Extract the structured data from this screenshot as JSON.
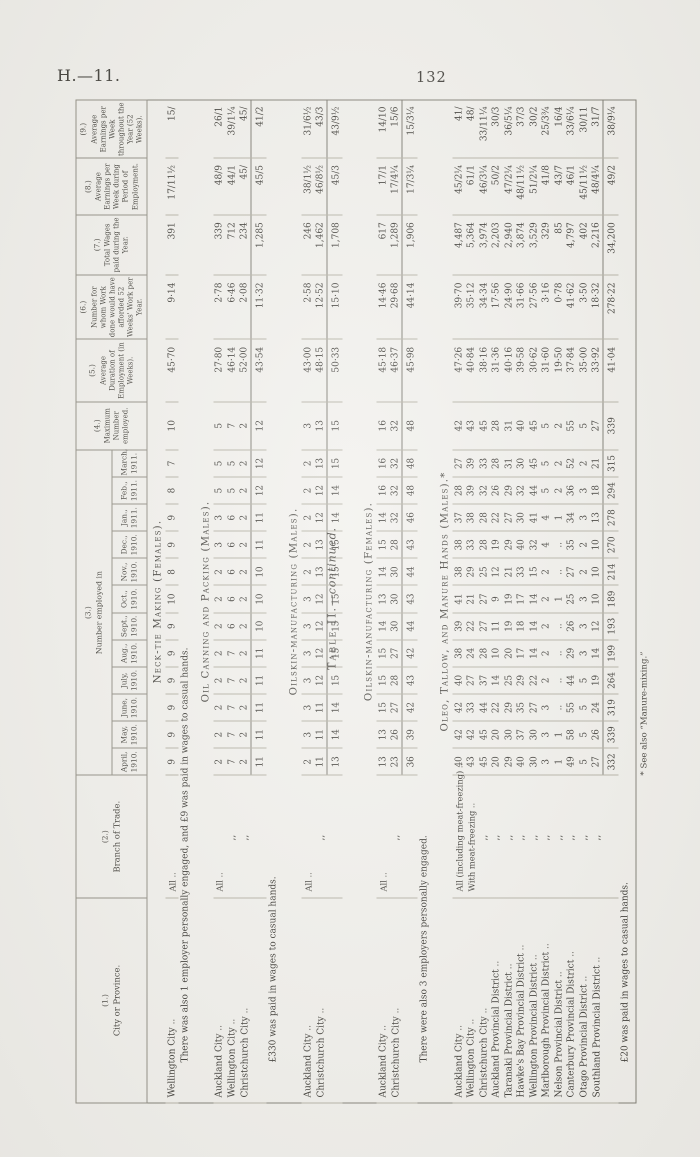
{
  "page": {
    "doc_ref": "H.—11.",
    "page_number": "132",
    "table_title_main": "Table II.",
    "table_title_cont": "—continued.",
    "footnote": "* See also “Manure-mixing.”"
  },
  "table": {
    "headers": {
      "c1": {
        "num": "(1.)",
        "label": "City or Province."
      },
      "c2": {
        "num": "(2.)",
        "label": "Branch of Trade."
      },
      "c3": {
        "num": "(3.)",
        "label": "Number employed in"
      },
      "months": [
        {
          "name": "April,",
          "year": "1910."
        },
        {
          "name": "May,",
          "year": "1910."
        },
        {
          "name": "June,",
          "year": "1910."
        },
        {
          "name": "July,",
          "year": "1910."
        },
        {
          "name": "Aug.,",
          "year": "1910."
        },
        {
          "name": "Sept.,",
          "year": "1910."
        },
        {
          "name": "Oct.,",
          "year": "1910."
        },
        {
          "name": "Nov.,",
          "year": "1910."
        },
        {
          "name": "Dec.,",
          "year": "1910."
        },
        {
          "name": "Jan.,",
          "year": "1911."
        },
        {
          "name": "Feb.,",
          "year": "1911."
        },
        {
          "name": "March,",
          "year": "1911."
        }
      ],
      "c4": {
        "num": "(4.)",
        "label": "Maximum Number employed."
      },
      "c5": {
        "num": "(5.)",
        "label": "Average Duration of Employment (in Weeks)."
      },
      "c6": {
        "num": "(6.)",
        "label": "Number for whom Work done would have afforded 52 Weeks' Work per Year."
      },
      "c7": {
        "num": "(7.)",
        "label": "Total Wages paid during the Year."
      },
      "c8": {
        "num": "(8.)",
        "label": "Average Earnings per Week during Period of Employment."
      },
      "c9": {
        "num": "(9.)",
        "label": "Average Earnings per Week throughout the Year (52 Weeks)."
      }
    },
    "sections": [
      {
        "title": "Neck-tie Making (Females).",
        "rows": [
          {
            "city": "Wellington City",
            "branch": "All",
            "months": [
              9,
              9,
              9,
              9,
              9,
              9,
              10,
              8,
              9,
              9,
              8,
              7
            ],
            "max": 10,
            "avg_duration": "45·70",
            "weeks_work_number": "9·14",
            "total_wages": "391",
            "earnings_period": "17/11½",
            "earnings_year": "15/"
          }
        ],
        "note": "There was also 1 employer personally engaged, and £9 was paid in wages to casual hands."
      },
      {
        "title": "Oil Canning and Packing (Males).",
        "rows": [
          {
            "city": "Auckland City",
            "branch": "All",
            "months": [
              2,
              2,
              2,
              2,
              2,
              2,
              2,
              2,
              3,
              3,
              5,
              5
            ],
            "max": 5,
            "avg_duration": "27·80",
            "weeks_work_number": "2·78",
            "total_wages": "339",
            "earnings_period": "48/9",
            "earnings_year": "26/1"
          },
          {
            "city": "Wellington City",
            "branch": ",,",
            "months": [
              7,
              7,
              7,
              7,
              7,
              6,
              6,
              6,
              6,
              6,
              5,
              5
            ],
            "max": 7,
            "avg_duration": "46·14",
            "weeks_work_number": "6·46",
            "total_wages": "712",
            "earnings_period": "44/1",
            "earnings_year": "39/1¼"
          },
          {
            "city": "Christchurch City",
            "branch": ",,",
            "months": [
              2,
              2,
              2,
              2,
              2,
              2,
              2,
              2,
              2,
              2,
              2,
              2
            ],
            "max": 2,
            "avg_duration": "52·00",
            "weeks_work_number": "2·08",
            "total_wages": "234",
            "earnings_period": "45/",
            "earnings_year": "45/"
          }
        ],
        "totals": {
          "months": [
            11,
            11,
            11,
            11,
            11,
            10,
            10,
            10,
            11,
            11,
            12,
            12
          ],
          "max": 12,
          "avg_duration": "43·54",
          "weeks_work_number": "11·32",
          "total_wages": "1,285",
          "earnings_period": "45/5",
          "earnings_year": "41/2"
        },
        "note": "£330 was paid in wages to casual hands."
      },
      {
        "title": "Oilskin-manufacturing (Males).",
        "rows": [
          {
            "city": "Auckland City",
            "branch": "All",
            "months": [
              2,
              3,
              3,
              3,
              3,
              3,
              3,
              2,
              2,
              2,
              2,
              2
            ],
            "max": 3,
            "avg_duration": "43·00",
            "weeks_work_number": "2·58",
            "total_wages": "246",
            "earnings_period": "38/1½",
            "earnings_year": "31/6½"
          },
          {
            "city": "Christchurch City",
            "branch": ",,",
            "months": [
              11,
              11,
              11,
              12,
              12,
              12,
              12,
              13,
              13,
              12,
              12,
              13
            ],
            "max": 13,
            "avg_duration": "48·15",
            "weeks_work_number": "12·52",
            "total_wages": "1,462",
            "earnings_period": "46/8½",
            "earnings_year": "43/3"
          }
        ],
        "totals": {
          "months": [
            13,
            14,
            14,
            15,
            15,
            15,
            15,
            15,
            15,
            14,
            14,
            15
          ],
          "max": 15,
          "avg_duration": "50·33",
          "weeks_work_number": "15·10",
          "total_wages": "1,708",
          "earnings_period": "45/3",
          "earnings_year": "43/9½"
        }
      },
      {
        "title": "Oilskin-manufacturing (Females).",
        "rows": [
          {
            "city": "Auckland City",
            "branch": "All",
            "months": [
              13,
              13,
              15,
              15,
              15,
              14,
              13,
              14,
              15,
              14,
              16,
              16
            ],
            "max": 16,
            "avg_duration": "45·18",
            "weeks_work_number": "14·46",
            "total_wages": "617",
            "earnings_period": "17/1",
            "earnings_year": "14/10"
          },
          {
            "city": "Christchurch City",
            "branch": ",,",
            "months": [
              23,
              26,
              27,
              28,
              27,
              30,
              30,
              30,
              28,
              32,
              32,
              32
            ],
            "max": 32,
            "avg_duration": "46·37",
            "weeks_work_number": "29·68",
            "total_wages": "1,289",
            "earnings_period": "17/4¼",
            "earnings_year": "15/6"
          }
        ],
        "totals": {
          "months": [
            36,
            39,
            42,
            43,
            42,
            44,
            43,
            44,
            43,
            46,
            48,
            48
          ],
          "max": 48,
          "avg_duration": "45·98",
          "weeks_work_number": "44·14",
          "total_wages": "1,906",
          "earnings_period": "17/3¼",
          "earnings_year": "15/3¼"
        },
        "note": "There were also 3 employers personally engaged."
      },
      {
        "title": "Oleo, Tallow, and Manure Hands (Males).*",
        "rows": [
          {
            "city": "Auckland City",
            "branch": "All (including meat-freezing)",
            "months": [
              40,
              42,
              42,
              40,
              38,
              39,
              41,
              38,
              38,
              37,
              28,
              27
            ],
            "max": 42,
            "avg_duration": "47·26",
            "weeks_work_number": "39·70",
            "total_wages": "4,487",
            "earnings_period": "45/2¼",
            "earnings_year": "41/"
          },
          {
            "city": "Wellington City",
            "branch": "With meat-freezing",
            "months": [
              43,
              42,
              33,
              27,
              24,
              22,
              21,
              29,
              33,
              38,
              39,
              39
            ],
            "max": 43,
            "avg_duration": "40·84",
            "weeks_work_number": "35·12",
            "total_wages": "5,364",
            "earnings_period": "61/1",
            "earnings_year": "48/"
          },
          {
            "city": "Christchurch City",
            "branch": ",,",
            "months": [
              45,
              45,
              44,
              37,
              28,
              27,
              27,
              25,
              28,
              28,
              32,
              33
            ],
            "max": 45,
            "avg_duration": "38·16",
            "weeks_work_number": "34·34",
            "total_wages": "3,974",
            "earnings_period": "46/3¼",
            "earnings_year": "33/11¼"
          },
          {
            "city": "Auckland Provincial District",
            "branch": ",,",
            "months": [
              20,
              20,
              22,
              14,
              10,
              11,
              9,
              12,
              19,
              22,
              26,
              28
            ],
            "max": 28,
            "avg_duration": "31·36",
            "weeks_work_number": "17·56",
            "total_wages": "2,203",
            "earnings_period": "50/2",
            "earnings_year": "30/3"
          },
          {
            "city": "Taranaki Provincial District",
            "branch": ",,",
            "months": [
              29,
              30,
              29,
              25,
              20,
              19,
              19,
              21,
              29,
              27,
              29,
              31
            ],
            "max": 31,
            "avg_duration": "40·16",
            "weeks_work_number": "24·90",
            "total_wages": "2,940",
            "earnings_period": "47/2¼",
            "earnings_year": "36/5¼"
          },
          {
            "city": "Hawke's Bay Provincial District",
            "branch": ",,",
            "months": [
              40,
              37,
              35,
              29,
              17,
              18,
              17,
              33,
              40,
              30,
              32,
              30
            ],
            "max": 40,
            "avg_duration": "39·58",
            "weeks_work_number": "31·66",
            "total_wages": "3,874",
            "earnings_period": "48/11½",
            "earnings_year": "37/3"
          },
          {
            "city": "Wellington Provincial District",
            "branch": ",,",
            "months": [
              30,
              30,
              27,
              22,
              14,
              14,
              14,
              15,
              32,
              41,
              44,
              45
            ],
            "max": 45,
            "avg_duration": "30·62",
            "weeks_work_number": "27·56",
            "total_wages": "3,529",
            "earnings_period": "51/2¼",
            "earnings_year": "30/2"
          },
          {
            "city": "Marlborough Provincial District",
            "branch": ",,",
            "months": [
              3,
              3,
              3,
              2,
              2,
              2,
              2,
              2,
              4,
              4,
              5,
              5
            ],
            "max": 5,
            "avg_duration": "31·60",
            "weeks_work_number": "3·16",
            "total_wages": "329",
            "earnings_period": "41/8",
            "earnings_year": "25/3¾"
          },
          {
            "city": "Nelson Provincial District",
            "branch": ",,",
            "months": [
              1,
              1,
              "..",
              "..",
              "..",
              "..",
              1,
              "..",
              "..",
              1,
              2,
              2
            ],
            "max": 2,
            "avg_duration": "19·50",
            "weeks_work_number": "0·78",
            "total_wages": "85",
            "earnings_period": "43/7",
            "earnings_year": "16/4"
          },
          {
            "city": "Canterbury Provincial District",
            "branch": ",,",
            "months": [
              49,
              58,
              55,
              44,
              29,
              26,
              25,
              27,
              35,
              34,
              36,
              52
            ],
            "max": 55,
            "avg_duration": "37·84",
            "weeks_work_number": "41·62",
            "total_wages": "4,797",
            "earnings_period": "46/1",
            "earnings_year": "33/6¼"
          },
          {
            "city": "Otago Provincial District",
            "branch": ",,",
            "months": [
              5,
              5,
              5,
              5,
              3,
              3,
              3,
              2,
              2,
              3,
              3,
              2
            ],
            "max": 5,
            "avg_duration": "35·00",
            "weeks_work_number": "3·50",
            "total_wages": "402",
            "earnings_period": "45/11½",
            "earnings_year": "30/11"
          },
          {
            "city": "Southland Provincial District",
            "branch": ",,",
            "months": [
              27,
              26,
              24,
              19,
              14,
              12,
              10,
              10,
              10,
              13,
              18,
              21
            ],
            "max": 27,
            "avg_duration": "33·92",
            "weeks_work_number": "18·32",
            "total_wages": "2,216",
            "earnings_period": "48/4¼",
            "earnings_year": "31/7"
          }
        ],
        "totals": {
          "months": [
            332,
            339,
            319,
            264,
            199,
            193,
            189,
            214,
            270,
            278,
            294,
            315
          ],
          "max": 339,
          "avg_duration": "41·04",
          "weeks_work_number": "278·22",
          "total_wages": "34,200",
          "earnings_period": "49/2",
          "earnings_year": "38/9¼"
        },
        "note": "£20 was paid in wages to casual hands."
      }
    ]
  }
}
